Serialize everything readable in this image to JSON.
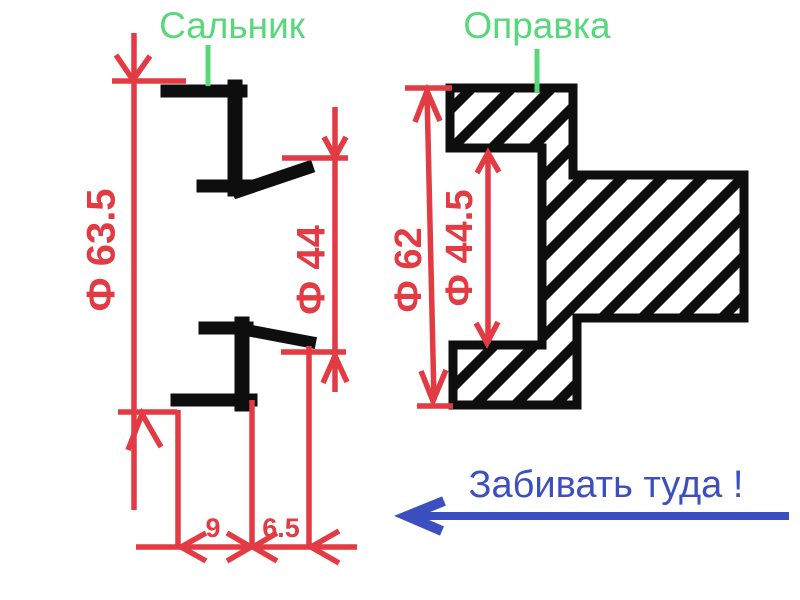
{
  "colors": {
    "dimension_red": "#e23b43",
    "label_green": "#57d87a",
    "annotation_blue": "#3b4fc1",
    "drawing_black": "#0e0e0e",
    "background": "#ffffff"
  },
  "labels": {
    "left_part": "Сальник",
    "right_part": "Оправка"
  },
  "seal": {
    "outer_diameter": "Ф 63.5",
    "bore_diameter": "Ф 44",
    "width": "9",
    "lip_depth": "6.5"
  },
  "mandrel": {
    "outer_diameter": "Ф 62",
    "pilot_diameter": "Ф 44.5"
  },
  "annotation": {
    "text": "Забивать туда !"
  }
}
